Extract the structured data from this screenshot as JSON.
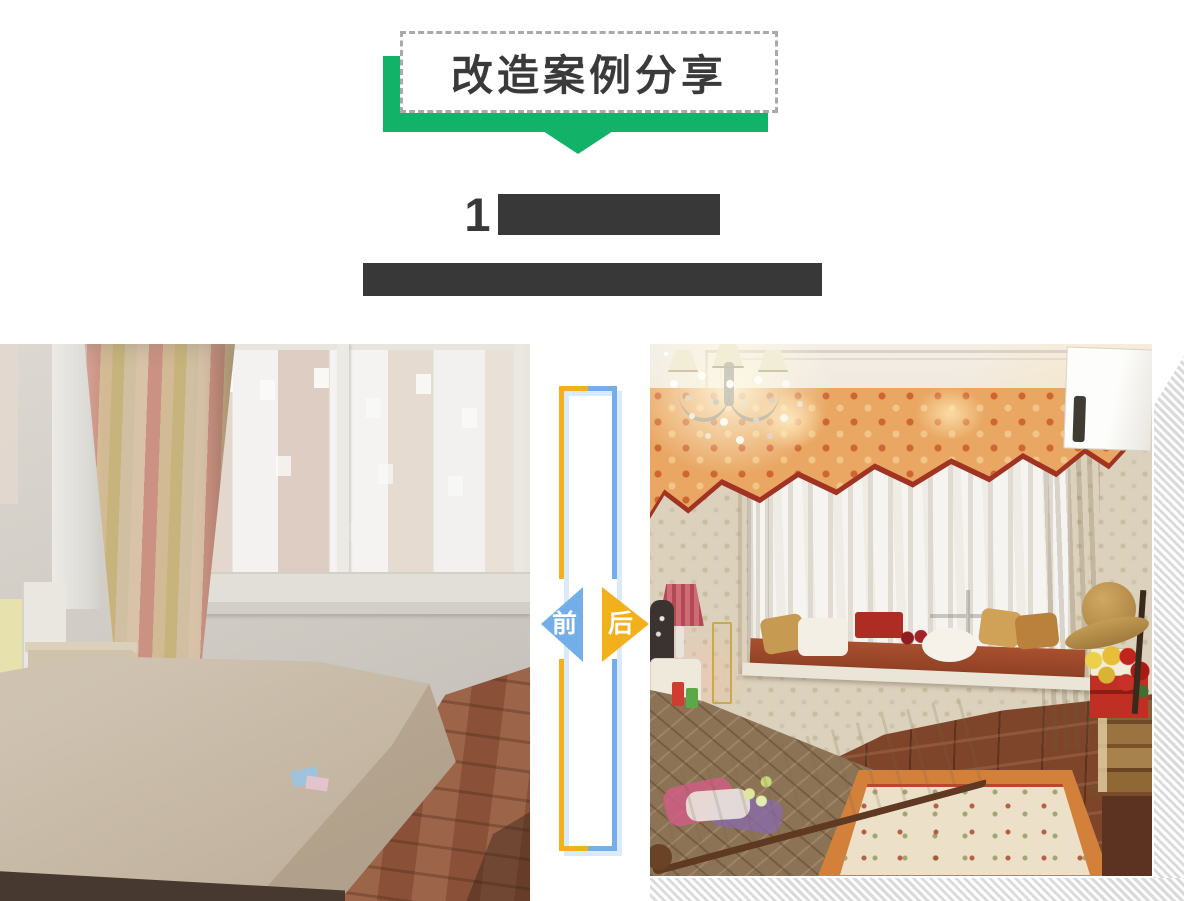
{
  "page": {
    "width": 1184,
    "height": 901,
    "background": "#ffffff"
  },
  "banner": {
    "title": "改造案例分享"
  },
  "headline": {
    "title_prefix": "1",
    "title_redacted": true,
    "subtitle_redacted": true
  },
  "comparison": {
    "before_label": "前",
    "after_label": "后"
  },
  "colors": {
    "banner_green": "#12b268",
    "dash_border": "#a9a9a9",
    "text_dark": "#3a3a3a",
    "redaction": "#383838",
    "arrow_blue": "#74aee8",
    "arrow_yellow": "#f2b01d",
    "frame_shadow": "#d9eafb",
    "hatch_gray": "#dadada"
  }
}
